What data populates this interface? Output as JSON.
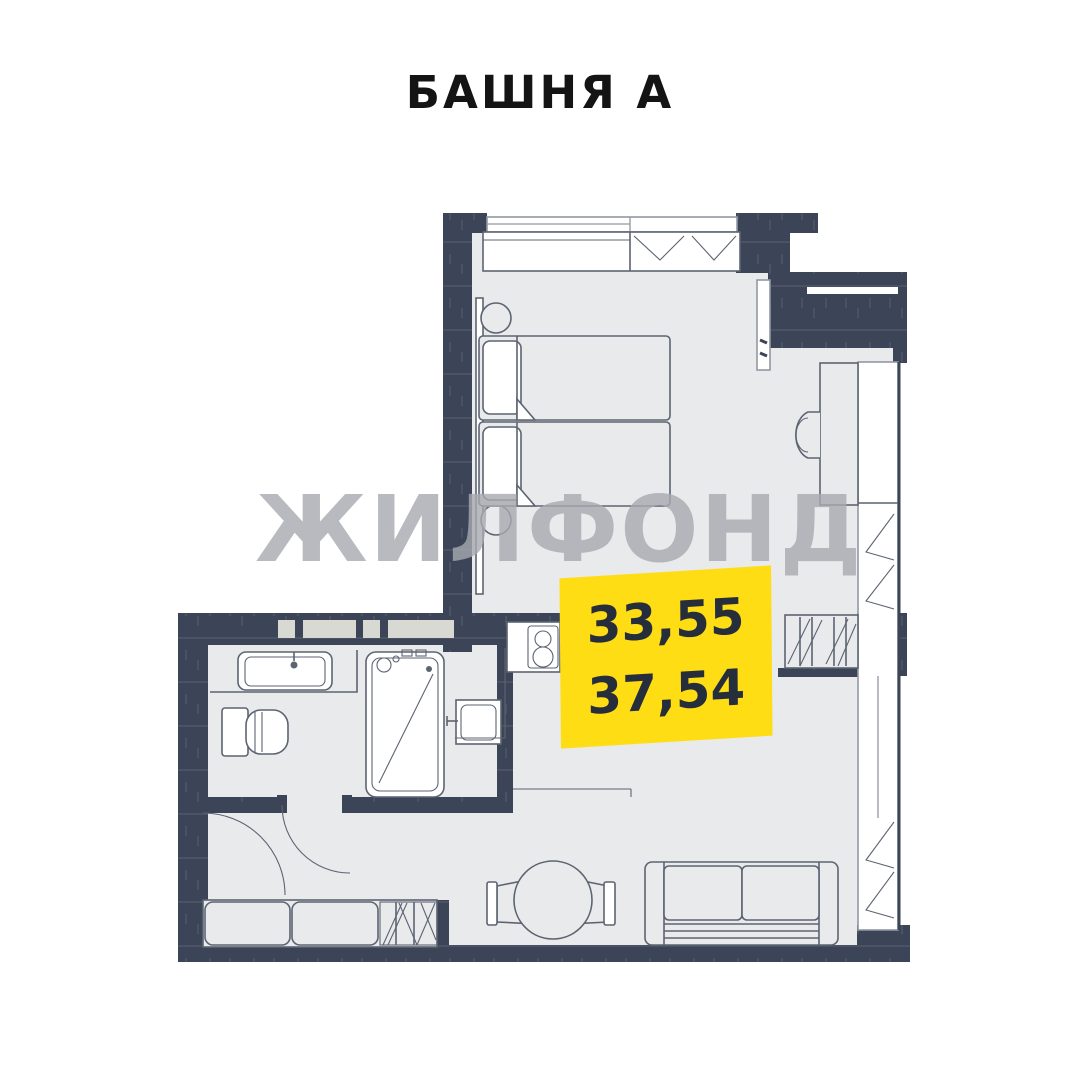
{
  "title": "БАШНЯ А",
  "watermark": "ЖИЛФОНД",
  "area_badge": {
    "line1": "33,55",
    "line2": "37,54"
  },
  "colors": {
    "wall": "#3C4557",
    "floor": "#E9EAEC",
    "badge_bg": "#FFDD15",
    "badge_text": "#272E3B",
    "watermark": "#A7AAB0",
    "furniture_line": "#5C6472",
    "title_text": "#141414"
  }
}
